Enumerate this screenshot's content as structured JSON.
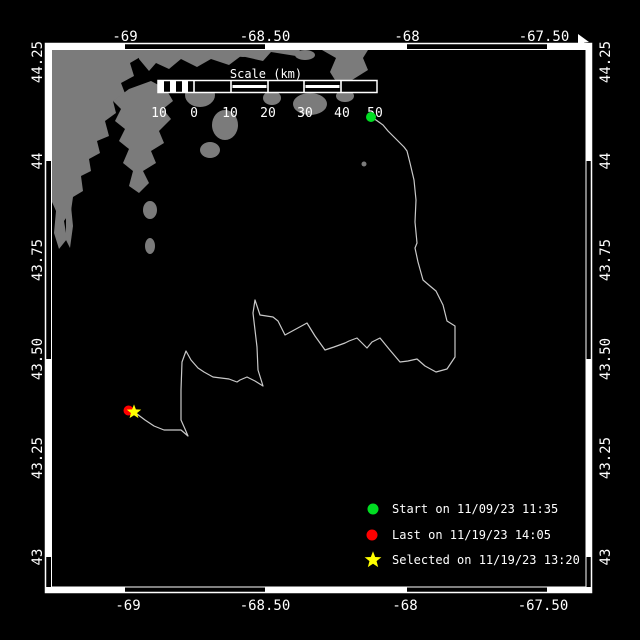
{
  "window": {
    "description": "drifter track map viewer"
  },
  "colors": {
    "background": "#000000",
    "land": "#7b7b7b",
    "track": "#c9c9c9",
    "frame": "#ffffff",
    "start": "#00dd22",
    "last": "#ff0000",
    "selected": "#ffff00"
  },
  "axis": {
    "top": [
      "-69",
      "-68.50",
      "-68",
      "-67.50"
    ],
    "bottom": [
      "-69",
      "-68.50",
      "-68",
      "-67.50"
    ],
    "left": [
      "44.25",
      "44",
      "43.75",
      "43.50",
      "43.25",
      "43"
    ],
    "right": [
      "44.25",
      "44",
      "43.75",
      "43.50",
      "43.25",
      "43"
    ]
  },
  "scale_bar": {
    "title": "Scale (km)",
    "tick_labels": [
      "10",
      "0",
      "10",
      "20",
      "30",
      "40",
      "50"
    ]
  },
  "legend": {
    "items": [
      {
        "marker": "green-circle",
        "label": "Start on 11/09/23 11:35"
      },
      {
        "marker": "red-circle",
        "label": "Last on 11/19/23 14:05"
      },
      {
        "marker": "yellow-star",
        "label": "Selected on 11/19/23 13:20"
      }
    ]
  },
  "markers": {
    "start": {
      "x": 371,
      "y": 117
    },
    "last": {
      "x": 128.5,
      "y": 410.5
    },
    "selected": {
      "x": 134,
      "y": 412
    }
  },
  "track": {
    "points": [
      [
        371,
        117
      ],
      [
        376,
        120
      ],
      [
        383,
        125
      ],
      [
        388,
        131
      ],
      [
        396,
        139
      ],
      [
        404,
        147
      ],
      [
        407,
        151
      ],
      [
        410,
        163
      ],
      [
        414,
        180
      ],
      [
        416,
        200
      ],
      [
        415,
        222
      ],
      [
        417,
        243
      ],
      [
        415,
        248
      ],
      [
        418,
        262
      ],
      [
        423,
        280
      ],
      [
        430,
        286
      ],
      [
        436,
        291
      ],
      [
        443,
        305
      ],
      [
        447,
        321
      ],
      [
        455,
        326
      ],
      [
        455,
        357
      ],
      [
        447,
        369
      ],
      [
        436,
        372
      ],
      [
        425,
        366
      ],
      [
        417,
        359
      ],
      [
        408,
        361
      ],
      [
        400,
        362
      ],
      [
        389,
        349
      ],
      [
        380,
        338
      ],
      [
        372,
        342
      ],
      [
        367,
        348
      ],
      [
        361,
        342
      ],
      [
        357,
        338
      ],
      [
        349,
        341
      ],
      [
        345,
        343
      ],
      [
        334,
        347
      ],
      [
        325,
        350
      ],
      [
        315,
        336
      ],
      [
        307,
        323
      ],
      [
        296,
        329
      ],
      [
        285,
        335
      ],
      [
        278,
        321
      ],
      [
        273,
        317
      ],
      [
        260,
        315
      ],
      [
        255,
        300
      ],
      [
        253,
        313
      ],
      [
        257,
        347
      ],
      [
        258,
        370
      ],
      [
        263,
        386
      ],
      [
        255,
        381
      ],
      [
        247,
        377
      ],
      [
        240,
        380
      ],
      [
        237,
        382
      ],
      [
        229,
        379
      ],
      [
        213,
        377
      ],
      [
        204,
        372
      ],
      [
        198,
        368
      ],
      [
        191,
        360
      ],
      [
        186,
        351
      ],
      [
        182,
        362
      ],
      [
        181,
        390
      ],
      [
        181,
        420
      ],
      [
        185,
        429
      ],
      [
        188,
        436
      ],
      [
        181,
        430
      ],
      [
        172,
        430
      ],
      [
        164,
        430
      ],
      [
        154,
        426
      ],
      [
        145,
        420
      ],
      [
        137,
        414
      ],
      [
        134,
        412
      ]
    ]
  }
}
